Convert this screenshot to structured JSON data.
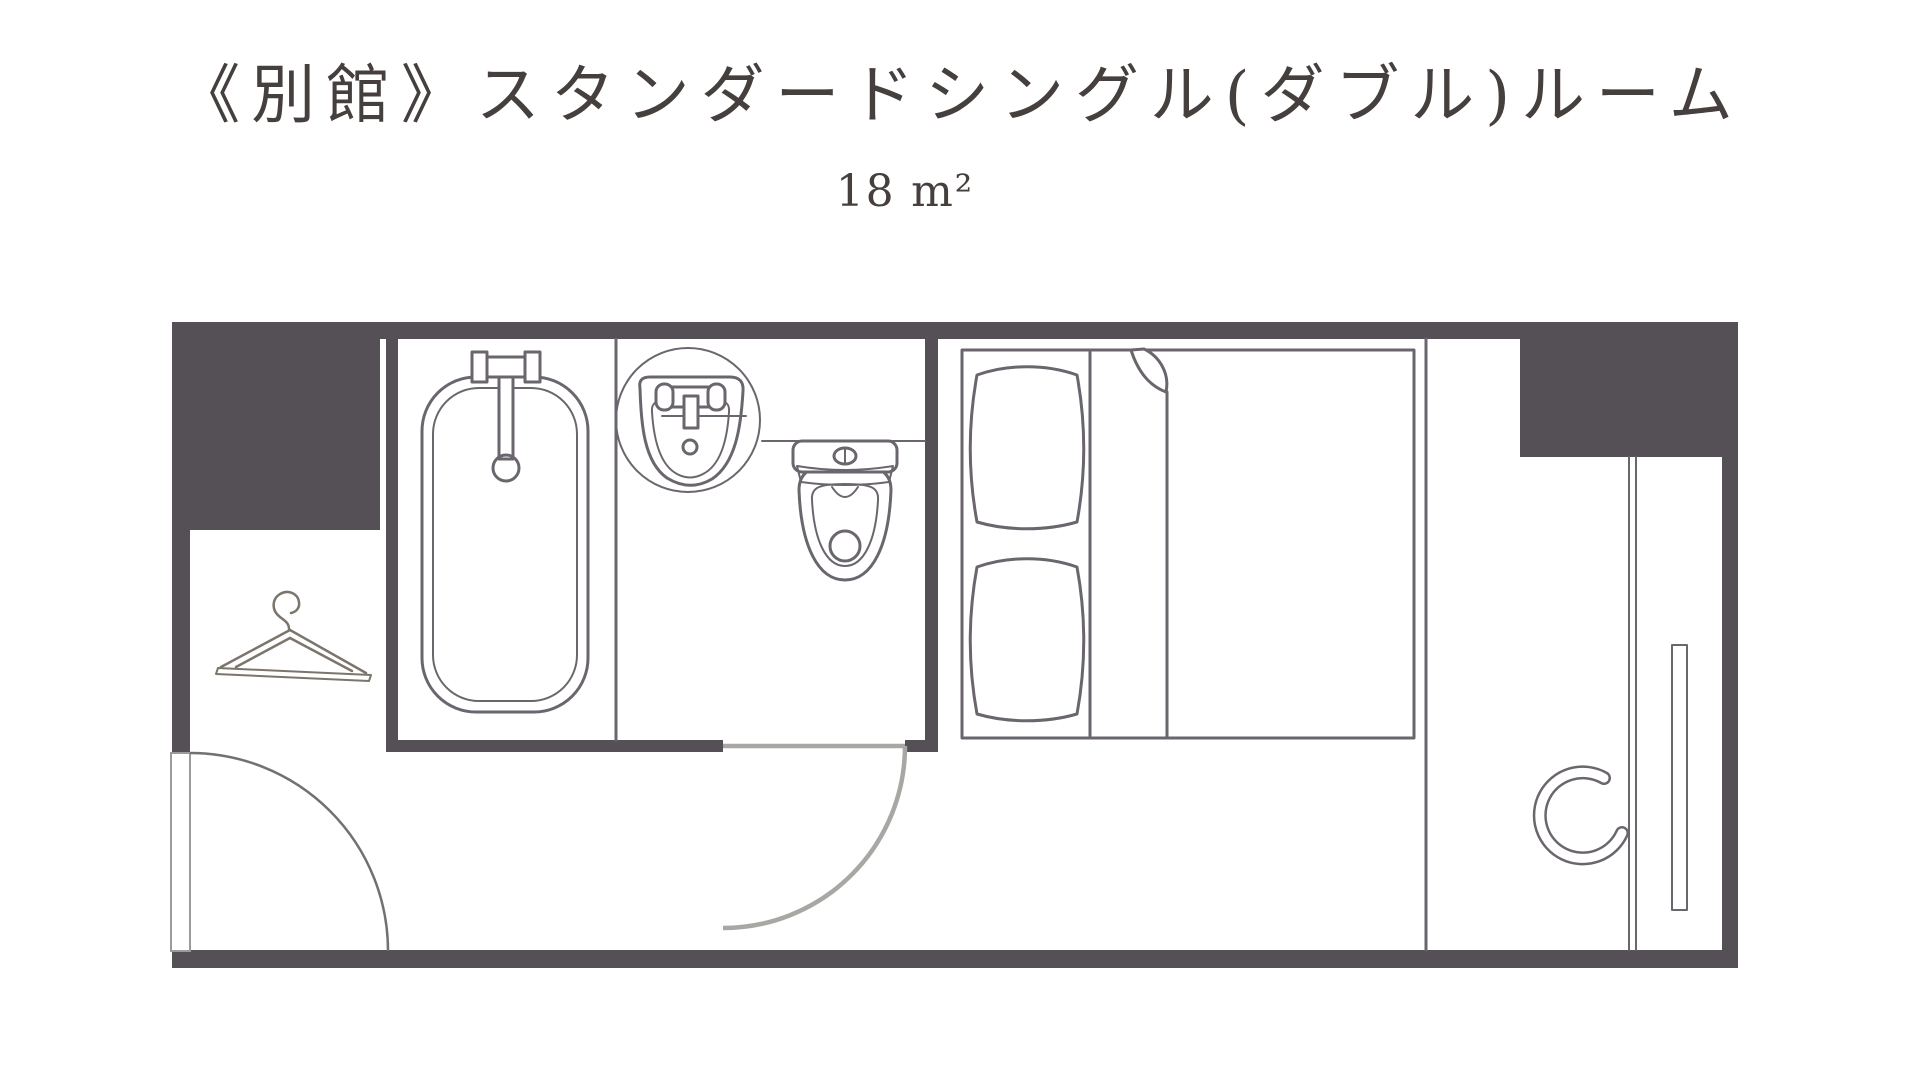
{
  "header": {
    "title": "《別館》スタンダードシングル(ダブル)ルーム",
    "area_label": "18 m²"
  },
  "colors": {
    "wall": "#545056",
    "line": "#6B666D",
    "door_swing": "#A8A7A4",
    "entry_swing": "#717171",
    "hanger": "#7B756C",
    "text": "#453F3D"
  }
}
